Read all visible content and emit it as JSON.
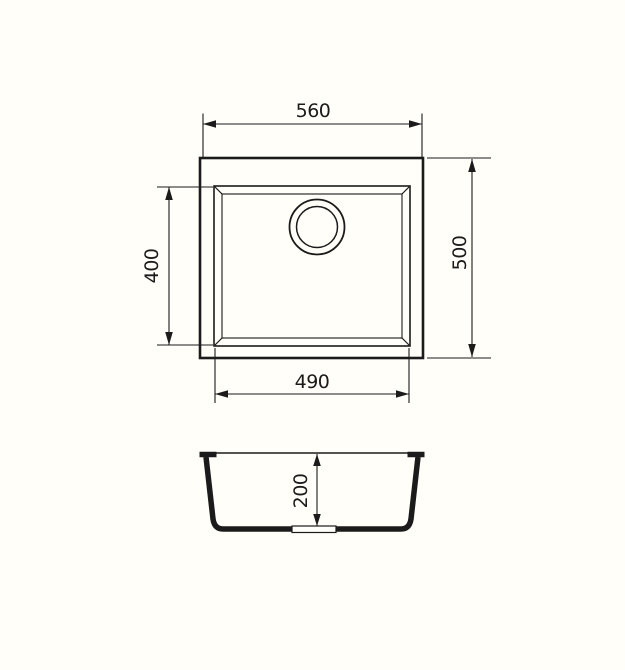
{
  "drawing": {
    "title": "sink-dimension-drawing",
    "subject": "undermount-kitchen-sink",
    "background_color": "#FFFEF9",
    "line_color": "#1B1B1B",
    "views": {
      "top_view": "plan view with bowl and drain",
      "section_view": "front cross-section with drain outlet"
    },
    "dimensions": {
      "overall_width": "560",
      "overall_depth": "500",
      "bowl_width": "490",
      "bowl_depth": "400",
      "bowl_height": "200"
    }
  }
}
